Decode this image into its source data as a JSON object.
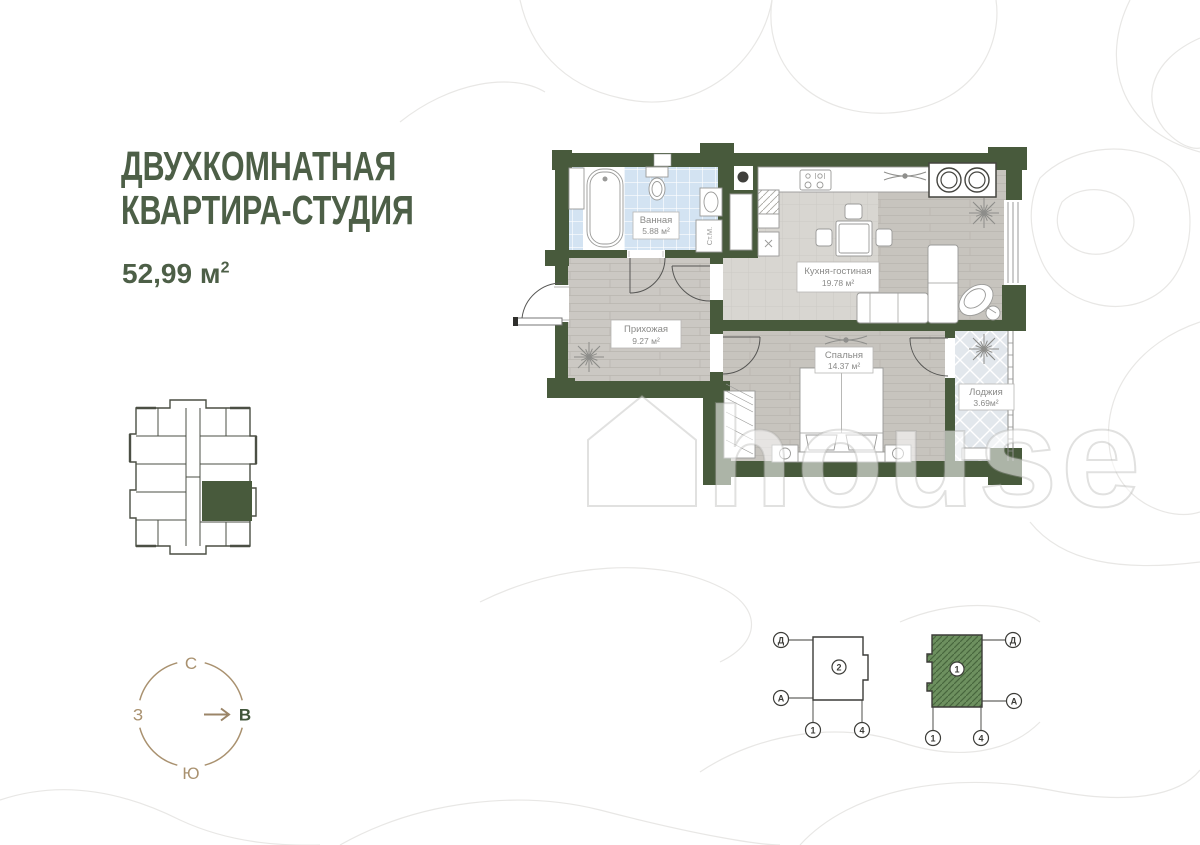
{
  "title": {
    "line1": "ДВУХКОМНАТНАЯ",
    "line2": "КВАРТИРА-СТУДИЯ",
    "area_value": "52,99 м",
    "area_sup": "2"
  },
  "rooms": {
    "bathroom": {
      "name": "Ванная",
      "area": "5.88 м²"
    },
    "kitchen": {
      "name": "Кухня-гостиная",
      "area": "19.78 м²"
    },
    "hallway": {
      "name": "Прихожая",
      "area": "9.27 м²"
    },
    "bedroom": {
      "name": "Спальня",
      "area": "14.37 м²"
    },
    "loggia": {
      "name": "Лоджия",
      "area": "3.69м²"
    }
  },
  "appliances": {
    "washing_machine": "Ст.М."
  },
  "compass": {
    "north": "С",
    "west": "З",
    "east": "В",
    "south": "Ю"
  },
  "diagrams": {
    "left": {
      "unit": "2",
      "axis_top": "Д",
      "axis_bottom": "А",
      "axis_col_left": "1",
      "axis_col_right": "4"
    },
    "right": {
      "unit": "1",
      "axis_top": "Д",
      "axis_bottom": "А",
      "axis_col_left": "1",
      "axis_col_right": "4"
    }
  },
  "watermark": {
    "text": "house"
  },
  "colors": {
    "wall_green": "#485a3c",
    "accent_green": "#4d5f47",
    "compass_tan": "#a9916f",
    "bathroom_tile": "#d3e3f2",
    "diagram_green": "#6d905f",
    "contour_grey": "#e8e7e5"
  }
}
